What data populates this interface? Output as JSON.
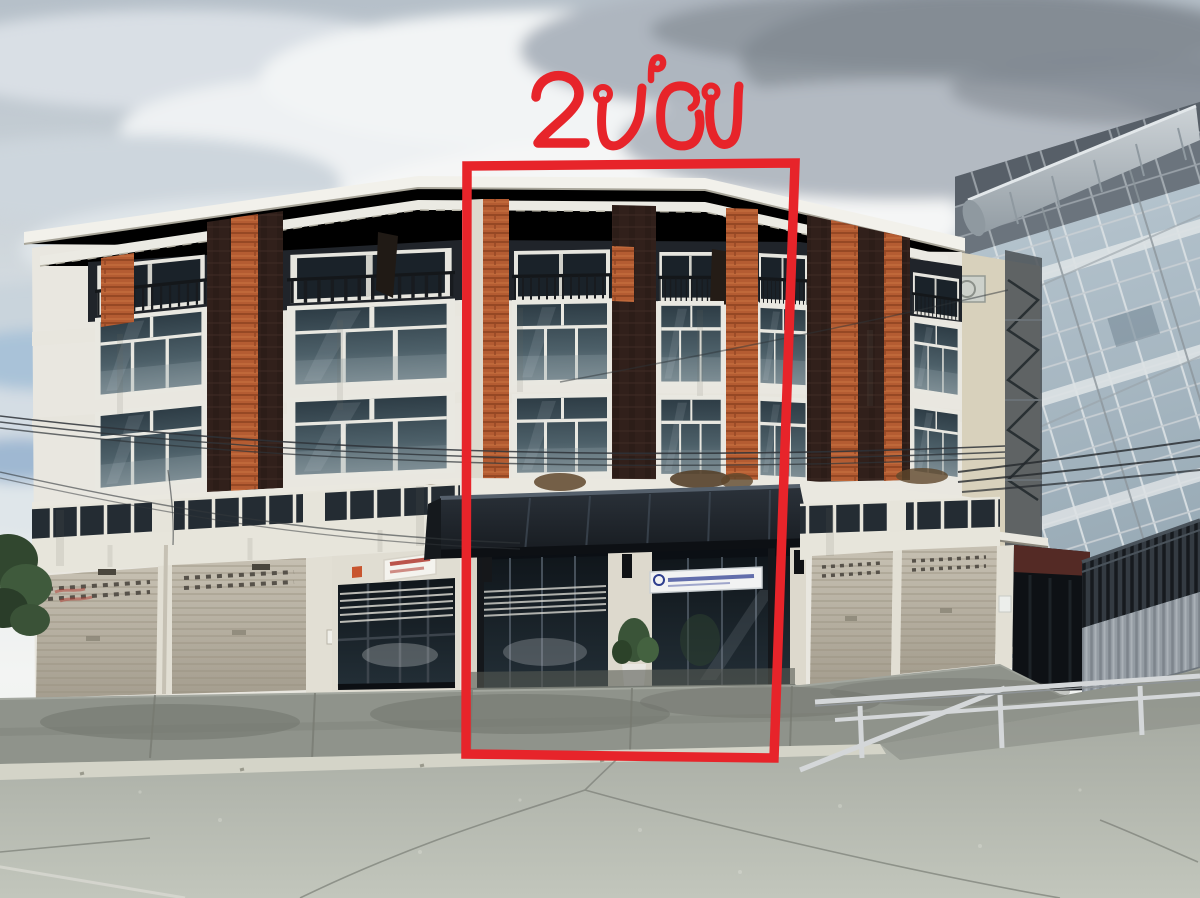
{
  "annotation": {
    "label": "2 ห้อง",
    "color": "#e7242a"
  },
  "palette": {
    "annotation_red": "#e7242a",
    "facade_white": "#e9e7e0",
    "brick_orange": "#b45c32",
    "dark_panel": "#31201b",
    "shutter_beige": "#b3ac9d",
    "canopy_dark": "#1d242b",
    "storefront_glass": "#10161b",
    "storefront_sign_red": "#b0392f",
    "company_sign_blue": "#4a57a0",
    "road_gray": "#b4b8af",
    "sky_light": "#dfe5e8",
    "neighbor_building_gray": "#a3b2bc",
    "fence_dark": "#2a3036",
    "guardrail_light": "#d4d7d9"
  }
}
